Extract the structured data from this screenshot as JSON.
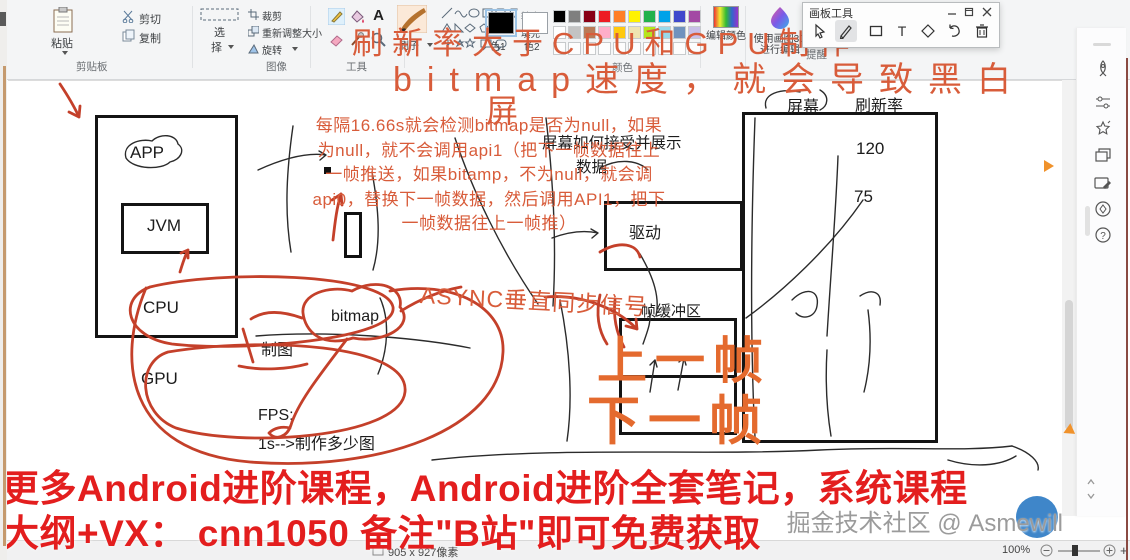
{
  "window": {
    "panel_title": "画板工具"
  },
  "glyphs": {
    "text_tool": "A",
    "panel_text": "T",
    "help": "?"
  },
  "colors": {
    "annotation_red": "#d85c3a",
    "big_frame_orange": "#e46a2e",
    "promo_red": "#e31e1e",
    "watermark_blue": "#3f86c9"
  },
  "ribbon": {
    "paste": "粘贴",
    "cut": "剪切",
    "copy": "复制",
    "group_clipboard": "剪贴板",
    "select_line1": "选",
    "select_line2": "择",
    "crop": "裁剪",
    "resize": "重新调整大小",
    "rotate": "旋转",
    "group_image": "图像",
    "group_tools": "工具",
    "brush": "刷子",
    "outline": "轮廓",
    "fill": "填充",
    "color1": "色1",
    "color2": "色2",
    "group_colors": "颜色",
    "edit_colors": "编辑颜色",
    "paint3d": "使用画图3D进行编辑",
    "group_hint": "提醒",
    "palette_row1": [
      "#000000",
      "#7f7f7f",
      "#880015",
      "#ed1c24",
      "#ff7f27",
      "#fff200",
      "#22b14c",
      "#00a2e8",
      "#3f48cc",
      "#a349a4"
    ],
    "palette_row2": [
      "#ffffff",
      "#c3c3c3",
      "#b97a57",
      "#ffaec9",
      "#ffc90e",
      "#efe4b0",
      "#b5e61d",
      "#99d9ea",
      "#7092be",
      "#c8bfe7"
    ],
    "palette_row3": [
      "#fdfdfd",
      "#fdfdfd",
      "#fdfdfd",
      "#fdfdfd",
      "#fdfdfd",
      "#fdfdfd",
      "#fdfdfd",
      "#fdfdfd",
      "#fdfdfd",
      "#fdfdfd"
    ]
  },
  "diagram": {
    "app": "APP",
    "jvm": "JVM",
    "cpu": "CPU",
    "gpu": "GPU",
    "draw_label": "制图",
    "fps_label": "FPS:",
    "fps_desc": "1s-->制作多少图",
    "bitmap": "bitmap",
    "screen": "屏幕",
    "refresh_rate": "刷新率",
    "rate_high": "120",
    "rate_low": "75",
    "driver": "驱动",
    "screen_receive_line1": "屏幕如何接受并展示",
    "screen_receive_line2": "数据",
    "frame_buffer": "帧缓冲区",
    "prev_frame": "上一帧",
    "next_frame": "下一帧"
  },
  "annotations": {
    "title_line1": "刷新率大于CPU和GPU制作",
    "title_line2": "bitmap速度，就会导致黑白",
    "title_line3": "屏",
    "paragraph_lines": [
      "每隔16.66s就会检测bitmap是否为null，如果",
      "为null，就不会调用api1（把下一帧数据往上",
      "一帧推送，如果bitamp，不为null，就会调",
      "api0，替换下一帧数据，然后调用API1，把下",
      "一帧数据往上一帧推）"
    ],
    "async_label": "ASYNC垂直同步信号"
  },
  "promo": {
    "line1": "更多Android进阶课程，Android进阶全套笔记，系统课程",
    "line2": "大纲+VX：  cnn1050 备注\"B站\"即可免费获取"
  },
  "watermark": "掘金技术社区 @ Asmewill",
  "status": {
    "zoom_level": "100%",
    "canvas_size": "905 x 927像素"
  }
}
